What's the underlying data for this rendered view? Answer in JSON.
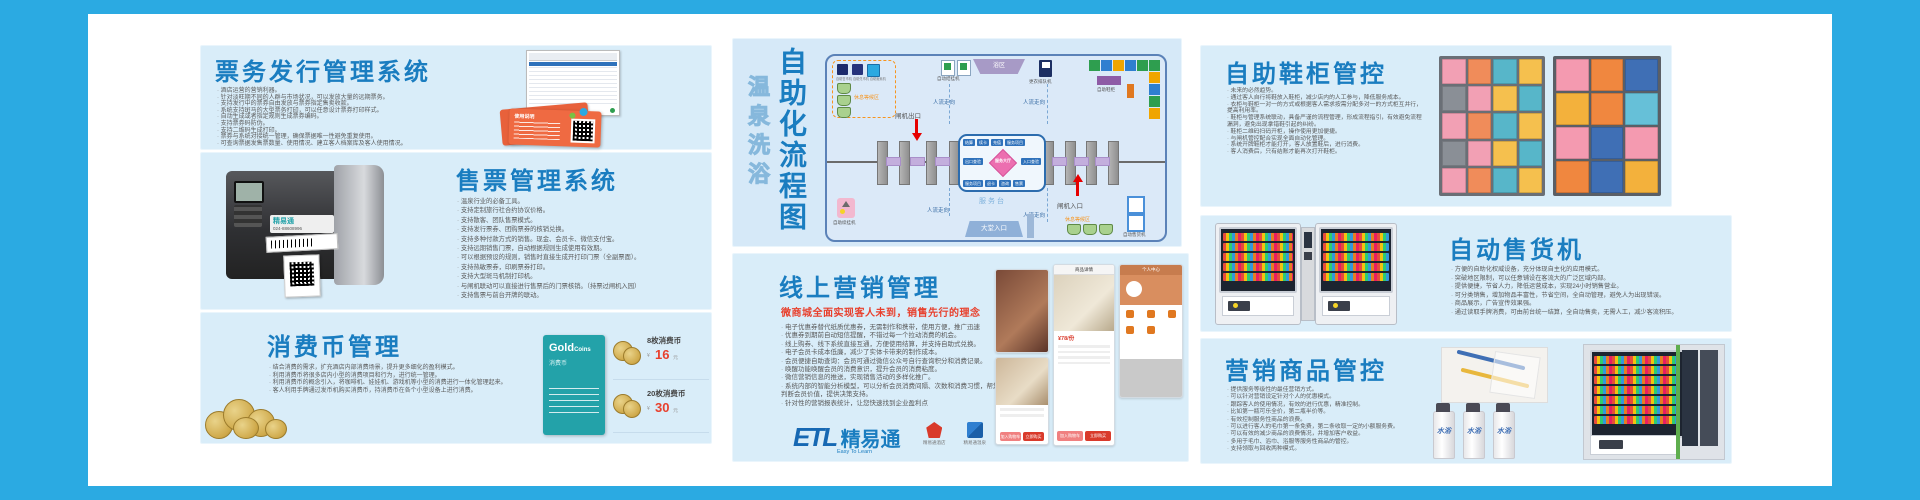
{
  "colors": {
    "frame": "#2baae2",
    "panel": "#d9edf9",
    "title_blue": "#1a7dc0",
    "accent_red": "#e8402d",
    "ticket_orange": "#e8613b",
    "card_teal": "#23a2a9"
  },
  "left_p1": {
    "title": "票务发行管理系统",
    "bullets": [
      "酒店运营的营销利器。",
      "针对淡旺期不同的人群与市场状况，可以发放大量的远期票务。",
      "支持发行中的票券自由发放与票券指定售卖收款。",
      "系统支持斑马的大型票务打印，可以任意设计票券打印样式。",
      "自动生成或者指定规则生成票券编码。",
      "支持票券码防伪。",
      "支持二维码生成打印。",
      "票券与系统对接统一管理，确保票据唯一性避免重复使用。",
      "可查询票据发售票数量、使用情况、建立客人档案库及客人使用情况。"
    ],
    "ticket_label": "使用说明"
  },
  "left_p2": {
    "title": "售票管理系统",
    "bullets": [
      "温泉行业的必备工具。",
      "支持定制旅行社合约协议价格。",
      "支持散客、团队售票模式。",
      "支持发行票券、团购票券的核销兑换。",
      "支持多种付款方式的销售。现金、会员卡、微信支付宝。",
      "支持远期销售门票，自动根据规则生成使用有效期。",
      "可以根据预设的规则，销售时直接生成开打印门票（全副票面）。",
      "支持热敏票券，印刷票券打印。",
      "支持大型斑马机制打印机。",
      "与闸机联动可以直接进行售票后的门票核销。（持票过闸机入园）",
      "支持售票与前台开牌的联动。"
    ],
    "printer_brand": "精易通",
    "printer_phone": "024-88608996"
  },
  "left_p3": {
    "title": "消费币管理",
    "bullets": [
      "结合消费的需求，扩充酒店内部消费场景，提升更多细化的盈利模式。",
      "利用消费币将很多店内小型的消费项目和行为，进行统一管理。",
      "利用消费币的概念引入，将咖啡机、娃娃机、游戏机等小型的消费进行一体化管理起来。",
      "客人利用手牌通过发币机购买消费币，持消费币在各个小型设备上进行消费。"
    ],
    "card_title": "Gold",
    "card_title2": "Coins",
    "card_sub": "消费币",
    "prices": [
      {
        "name": "8枚消费币",
        "currency": "¥",
        "value": "16",
        "unit": "元"
      },
      {
        "name": "20枚消费币",
        "currency": "¥",
        "value": "30",
        "unit": "元"
      }
    ]
  },
  "diagram": {
    "vtitle_light": "温泉洗浴",
    "vtitle": "自助化流程图",
    "waiting_label": "休息等候区",
    "waiting_machines": [
      "自助售币机",
      "自助兑币机",
      "自助贩卖机"
    ],
    "checkin": "自动结挂机",
    "bath": "浴区",
    "queue": "更衣排队机",
    "shoe": "自助鞋柜",
    "gate_exit": "闸机出口",
    "gate_entry": "闸机入口",
    "flow": "人流走向",
    "desk": "服务台",
    "lobby": "大堂入口",
    "rest": "休息等候区",
    "vending": "自动售货机",
    "hang": "自助续挂机",
    "hub": {
      "center": "服务大厅",
      "top": [
        "结算",
        "续卡",
        "充值",
        "服务项目"
      ],
      "left": "出口查验",
      "right": "入口查验",
      "bottom": [
        "服务项目",
        "退卡",
        "咨询",
        "售票"
      ]
    }
  },
  "marketing": {
    "title": "线上营销管理",
    "subtitle": "微商城全面实现客人未到，销售先行的理念",
    "bullets": [
      "电子优惠券替代纸质优惠券，无需制作和携带，使用方便，推广迅速",
      "优惠券到期前自动短信提醒，不错过每一个拉动消费的机会。",
      "线上购券、线下系统直接互通，方便使用结算，并支持自助式兑换。",
      "电子会员卡成本低廉，减少了实体卡带来的制作成本。",
      "会员便捷自助查询：会员可通过微信公众号自行查询积分和消费记录。",
      "唤醒功能唤醒会员的消费意识，提升会员的消费粘度。",
      "微信营销信息的推送，实现销售活动的多样化推广。",
      "系统内部的智能分析模型，可以分析会员消费间隔、次数和消费习惯，帮您精准判断会员价值，提供决策支持。",
      "针对性的营销报表统计，让您快速找到企业盈利点"
    ],
    "phones": {
      "detail_title": "商品详情",
      "price": "¥78/份",
      "btn_cart": "加入购物车",
      "btn_buy": "立即购买",
      "profile_title": "个人中心"
    },
    "logo": {
      "letters": "ETL",
      "brand": "精易通",
      "tagline": "Easy To Learn",
      "apps": [
        "精易通酒店",
        "精易通温泉",
        "精易通智能"
      ]
    }
  },
  "right_p1": {
    "title": "自助鞋柜管控",
    "bullets": [
      "未来的必然趋势。",
      "通过客人自行将鞋放入鞋柜，减少店内的人工参与，降低服务成本。",
      "衣柜与鞋柜一对一的方式或根据客人需求按需分配多对一的方式柜互并行，提高利用率。",
      "鞋柜与管理系统联动，具备严谨的流程管理，形成流程指引，有效避免流程漏洞，避免出现拿错鞋引起的纠纷。",
      "鞋柜二维码扫码开柜，操作使用更加便捷。",
      "与闸机管控配合实现全面自动化管理。",
      "系统开牌鞋柜才能打开，客人放置鞋后，进行消费。",
      "客人消费后，只有结账才能再次打开鞋柜。"
    ]
  },
  "right_p2": {
    "title": "自动售货机",
    "bullets": [
      "方便的自助化权威设备，充分体现自主化的应用模式。",
      "突破地区限制，可以任意铺设在客流大的广泛区域内部。",
      "提供便捷，节省人力，降低运营成本，实现24小时销售营业。",
      "可分类销售，增加物品丰富性，节省空间，全自动管理，避免人为出现错误。",
      "商品展示，广告宣传效果强。",
      "通过读取手牌消费，可由前台统一结算，全自动售卖，无需人工，减少客流积压。"
    ]
  },
  "right_p3": {
    "title": "营销商品管控",
    "bullets": [
      "提供服务等级性的最佳营销方式。",
      "可以针对营销设定针对个人的优惠模式。",
      "跟踪客人的使用情况，有效的进行优惠，精准控制。",
      "比如第一瓶可乐全价，第二瓶半价等。",
      "有效控制服务性商品的浪费。",
      "可以进行客人的毛巾第一条免费，第二条收取一定的小额服务费。",
      "可以有效的减少商品的浪费情况，并增加客户收益。",
      "多用于毛巾、浴巾、浴服等服务性商品的管控。",
      "支持领取与回收两种模式。"
    ],
    "bottle_label": "水浴"
  }
}
